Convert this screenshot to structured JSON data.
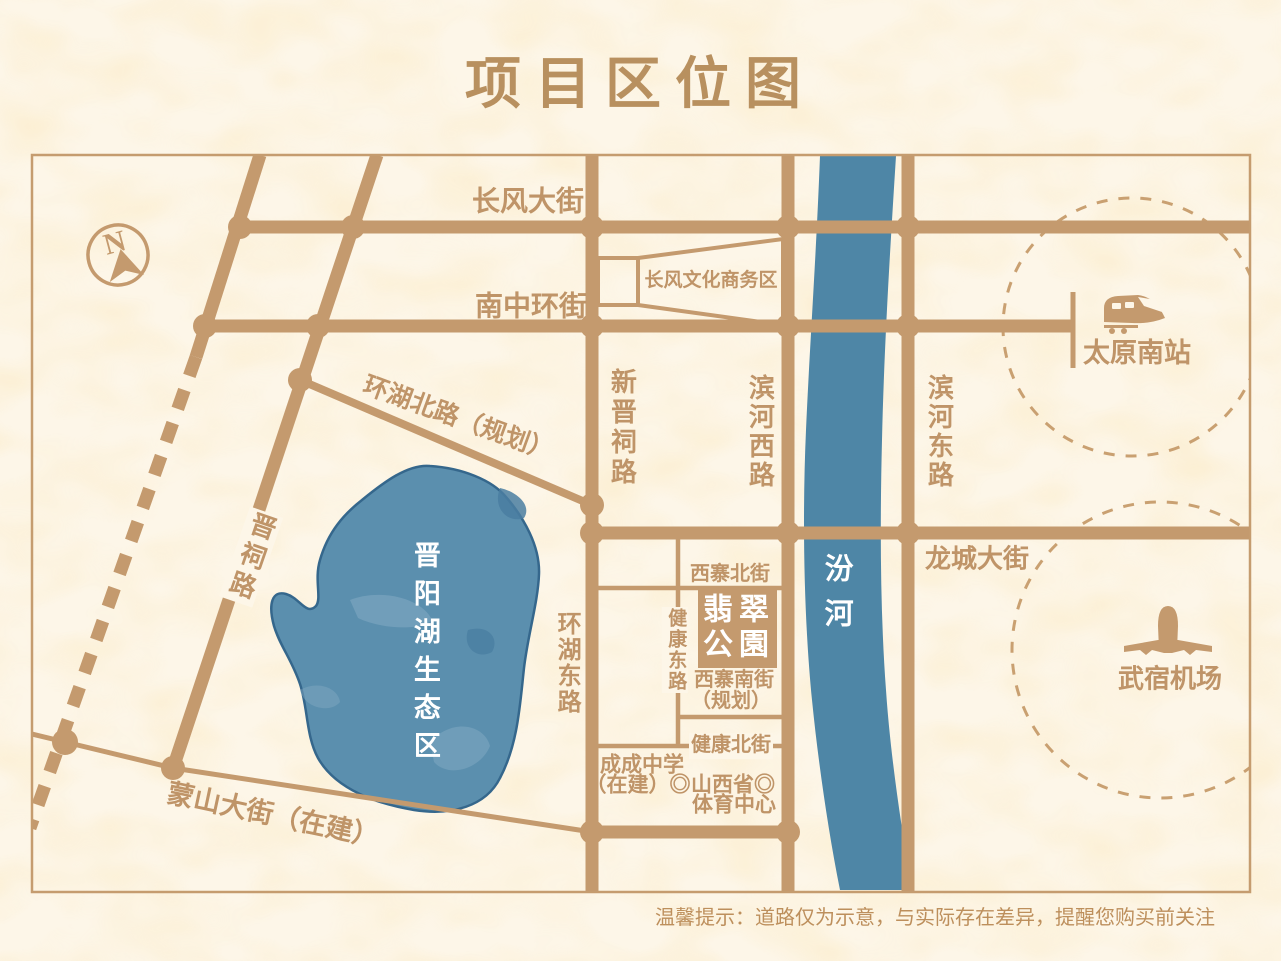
{
  "title": "项目区位图",
  "compass": {
    "letter": "N"
  },
  "roads": {
    "changfeng": "长风大街",
    "nanzhonghuan": "南中环街",
    "huanhu_north": "环湖北路（规划）",
    "jinci": "晋祠路",
    "xinjinci": "新晋祠路",
    "binhe_west": "滨河西路",
    "binhe_east": "滨河东路",
    "longcheng": "龙城大街",
    "huanhu_east": "环湖东路",
    "mengshan": "蒙山大街（在建）",
    "xizhai_north": "西寨北街",
    "jiankang_east": "健康东路",
    "xizhai_south_line1": "西寨南街",
    "xizhai_south_line2": "（规划）",
    "jiankang_north": "健康北街"
  },
  "water": {
    "river": "汾河",
    "lake": "晋阳湖生态区"
  },
  "pois": {
    "cbd": "长风文化商务区",
    "station": "太原南站",
    "airport": "武宿机场",
    "school_line1": "成成中学",
    "school_line2": "（在建）◎",
    "sports_line1": "山西省◎",
    "sports_line2": "体育中心"
  },
  "project": {
    "line1": "翡翠",
    "line2": "公園"
  },
  "disclaimer": "温馨提示：道路仅为示意，与实际存在差异，提醒您购买前关注",
  "colors": {
    "background": "#fdf6e8",
    "road": "#c49a6e",
    "label": "#bf9468",
    "title": "#b8905f",
    "river": "#4e86a6",
    "lake": "#5b8fae",
    "lake_outline": "#35678c",
    "white_text": "#ffffff"
  },
  "icons": {
    "compass": "compass-icon",
    "train": "train-icon",
    "plane": "plane-icon"
  }
}
